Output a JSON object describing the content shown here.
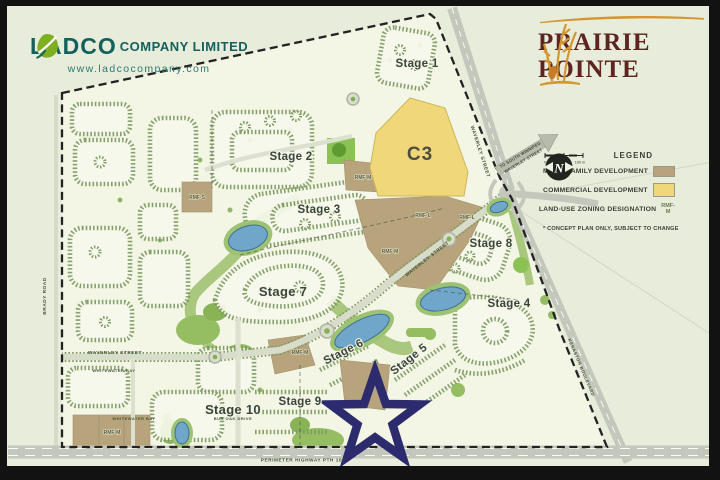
{
  "branding": {
    "ladco": {
      "name_left": "LADCO",
      "name_right": "COMPANY LIMITED",
      "website": "www.ladcocompany.com"
    },
    "prairie_pointe": {
      "line1": "PRAIRIE",
      "line2": "POINTE"
    }
  },
  "legend": {
    "title": "LEGEND",
    "items": [
      {
        "label": "MULTI-FAMILY DEVELOPMENT",
        "swatch": "#b7a47c"
      },
      {
        "label": "COMMERCIAL DEVELOPMENT",
        "swatch": "#f0d87a"
      },
      {
        "label": "LAND-USE ZONING DESIGNATION",
        "value": "RMF-M"
      }
    ],
    "note": "* CONCEPT PLAN ONLY, SUBJECT TO CHANGE",
    "scale": {
      "start": "0",
      "mid": "50",
      "end": "100 m"
    },
    "compass": "N"
  },
  "map": {
    "commercial_label": "C3",
    "stages": [
      "Stage 1",
      "Stage 2",
      "Stage 3",
      "Stage 4",
      "Stage 5",
      "Stage 6",
      "Stage 7",
      "Stage 8",
      "Stage 9",
      "Stage 10"
    ],
    "zones": [
      "RMF-S",
      "RMF-M",
      "RMF-L",
      "RMF-L",
      "RMF-M",
      "RMF-M",
      "RMF-M"
    ],
    "streets": [
      "WAVERLEY STREET",
      "WAVERLEY STREET",
      "WAVERLEY STREET",
      "BRADY ROAD",
      "WHITEWATER BAY",
      "WHITEWATER BAY",
      "KENASTON BOULEVARD",
      "PERIMETER HIGHWAY PTH 100",
      "BUR OAK DRIVE"
    ],
    "arrow": {
      "line1": "TO SOUTH WINNIPEG",
      "line2": "WAVERLEY STREET"
    }
  },
  "colors": {
    "ladco_teal": "#14605c",
    "ladco_leaf": "#7fae22",
    "pp_maroon": "#5e2422",
    "pp_gold": "#d4962f",
    "star_navy": "#2b2b6e",
    "multifamily_tan": "#b7a47c",
    "commercial_yellow": "#f0d87a",
    "pond_blue": "#6fa6c9",
    "park_green": "#95bd62",
    "background": "#e8eddb"
  }
}
